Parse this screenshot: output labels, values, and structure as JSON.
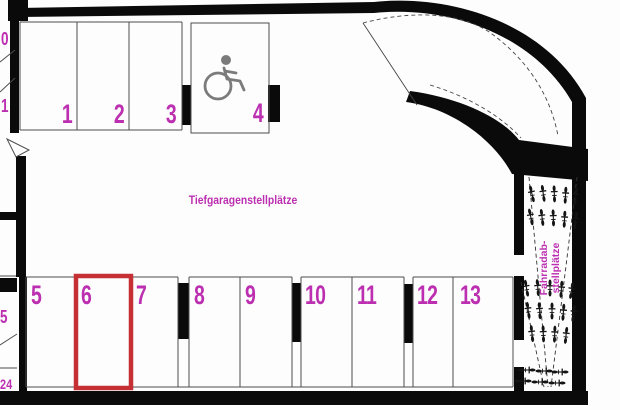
{
  "plan": {
    "title": "Tiefgaragenstellplätze",
    "bike_area_label": {
      "line1": "Fahrradab-",
      "line2": "stellplätze"
    },
    "highlighted_space": "6",
    "top_row": [
      {
        "number": "1"
      },
      {
        "number": "2"
      },
      {
        "number": "3"
      },
      {
        "number": "4",
        "accessible": true
      }
    ],
    "bottom_row": [
      {
        "number": "5"
      },
      {
        "number": "6",
        "highlighted": true
      },
      {
        "number": "7"
      },
      {
        "number": "8"
      },
      {
        "number": "9"
      },
      {
        "number": "10"
      },
      {
        "number": "11"
      },
      {
        "number": "12"
      },
      {
        "number": "13"
      }
    ],
    "edge_labels": {
      "top_a": "0",
      "top_b": "1",
      "bottom_a": "5",
      "bottom_b": "24"
    },
    "icons": {
      "accessible_space": "wheelchair-icon",
      "bike_parking": "bicycle-icon"
    },
    "colors": {
      "label_magenta": "#bb2fb0",
      "highlight_red": "#c63034",
      "wall_black": "#0a0a0a",
      "icon_gray": "#7b7b7b"
    }
  }
}
